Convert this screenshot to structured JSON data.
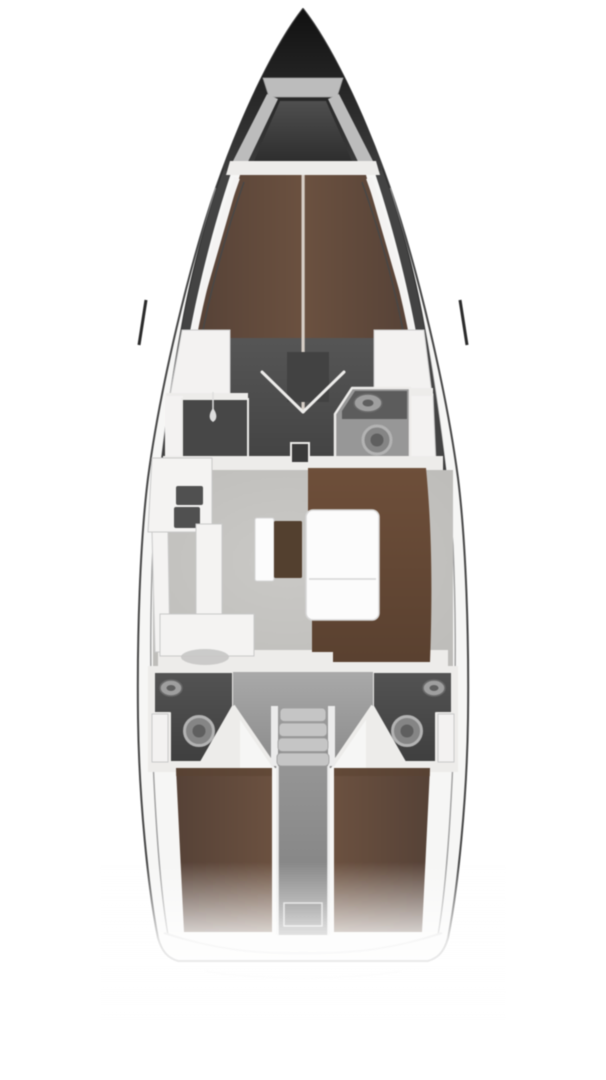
{
  "canvas": {
    "width": 606,
    "height": 1080
  },
  "diagram": {
    "kind": "yacht-interior-floor-plan",
    "orientation": "bow-up",
    "regions": [
      {
        "id": "bow-anchor-locker",
        "label": "bow anchor locker"
      },
      {
        "id": "forward-v-berth",
        "label": "forward cabin V-berth"
      },
      {
        "id": "forward-cabin-floor",
        "label": "forward cabin floor"
      },
      {
        "id": "port-wardrobe",
        "label": "port wardrobe locker"
      },
      {
        "id": "starboard-wardrobe",
        "label": "starboard wardrobe locker"
      },
      {
        "id": "shower-room",
        "label": "port shower compartment"
      },
      {
        "id": "forward-head",
        "label": "forward head with sink and toilet"
      },
      {
        "id": "mast-step",
        "label": "mast step"
      },
      {
        "id": "galley",
        "label": "L-shaped galley with sink and stove"
      },
      {
        "id": "nav-station",
        "label": "chart table with seat"
      },
      {
        "id": "salon-settee",
        "label": "U-shaped salon settee"
      },
      {
        "id": "salon-table",
        "label": "folding salon table"
      },
      {
        "id": "companionway-stairs",
        "label": "companionway steps"
      },
      {
        "id": "port-aft-head",
        "label": "port aft head"
      },
      {
        "id": "starboard-aft-head",
        "label": "starboard aft head"
      },
      {
        "id": "port-aft-berth",
        "label": "port aft cabin double berth"
      },
      {
        "id": "starboard-aft-berth",
        "label": "starboard aft cabin double berth"
      },
      {
        "id": "engine-compartment",
        "label": "engine compartment"
      },
      {
        "id": "transom",
        "label": "stern transom"
      }
    ]
  },
  "colors": {
    "background": "#ffffff",
    "hull_fill": "#f6f6f5",
    "hull_outline": "#474747",
    "hull_band_dark": "#2a2a2a",
    "inner_line": "#9f9f9f",
    "deck_white": "#f4f3f2",
    "wall_white": "#edecea",
    "locker_white": "#f3f2f1",
    "locker_stroke": "#c9c9c9",
    "bow_dark_top": "#111111",
    "bow_dark_bottom": "#3d3d3d",
    "anchor_gray": "#bcbcbc",
    "anchor_floor_top": "#4f4f4f",
    "anchor_floor_bottom": "#2e2e2e",
    "berth_brown": "#6b5140",
    "berth_brown_dark": "#564237",
    "berth_centerline": "#d6cec6",
    "cabin_floor": "#565656",
    "cabin_floor_dark": "#434343",
    "door_dark": "#424242",
    "shower_dark": "#474747",
    "shower_head": "#dedede",
    "head_floor": "#979797",
    "cabinet_dark": "#5c5c5c",
    "sink_fill": "#9f9f9f",
    "sink_rim": "#686868",
    "fixture_fill": "#858585",
    "fixture_rim": "#b3b3b3",
    "fixture_inner": "#5f5f5f",
    "mast_dark": "#3a3a3a",
    "salon_floor": "#bcbbb8",
    "salon_floor_light": "#cac9c6",
    "settee_brown": "#6e4f3a",
    "settee_brown_dark": "#5a4130",
    "table_white": "#fcfcfc",
    "table_line": "#d6d6d6",
    "nav_table_brown": "#53402f",
    "galley_white": "#f4f3f2",
    "appliance_dark": "#505050",
    "galley_seat": "#c6c6c5",
    "aft_head_top": "#535353",
    "aft_head_bottom": "#3f3f3f",
    "stair_tread": "#c5c5c5",
    "tread_edge": "#9a9a9a",
    "stair_rail": "#ebebeb",
    "stairwell_top": "#a9a9a9",
    "stairwell_bottom": "#8a8a8a",
    "engine_light": "#959595",
    "engine_dark": "#7e7e7e",
    "engine_box": "#717171",
    "engine_box_edge": "#d9d9d9",
    "transom_line": "#cfcfcf",
    "transom_line_faint": "#e6e6e6"
  }
}
